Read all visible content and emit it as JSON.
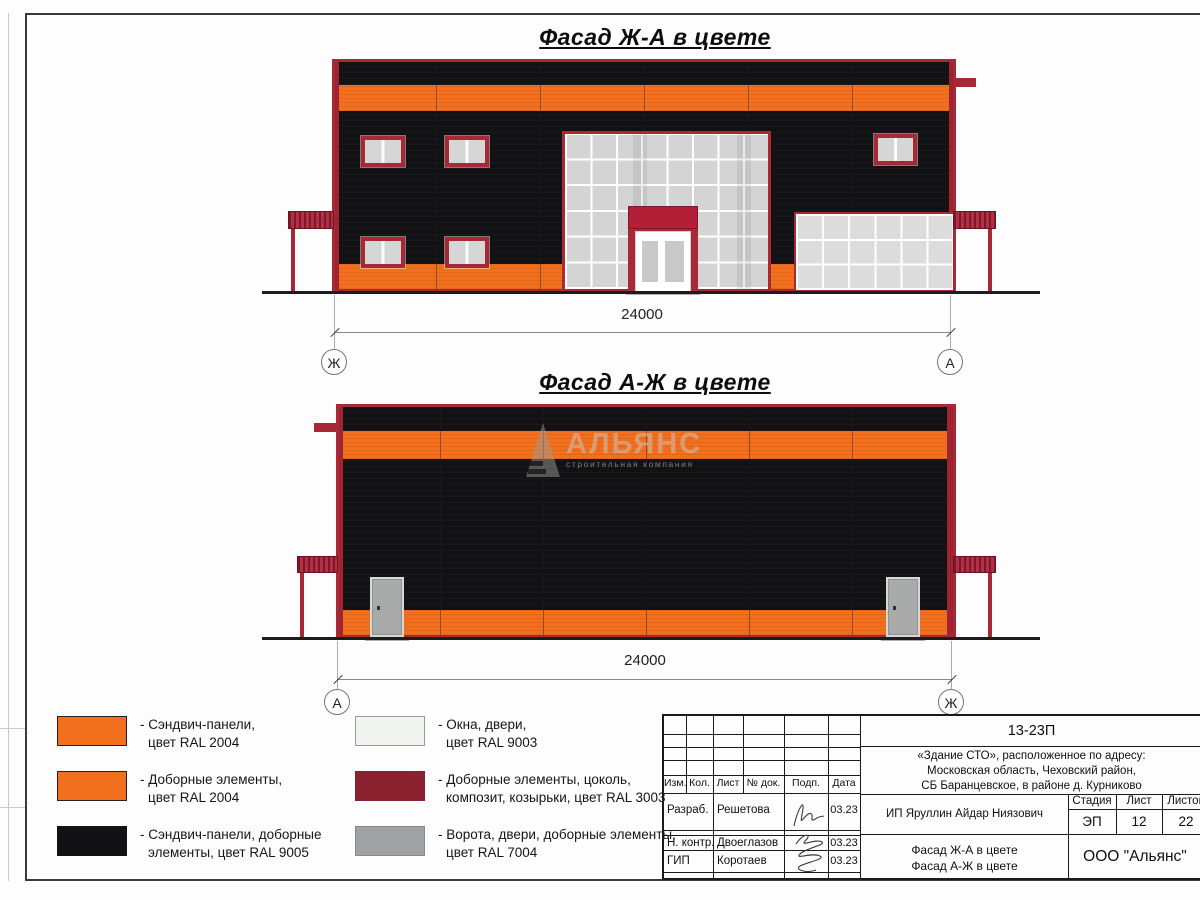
{
  "facade1": {
    "title": "Фасад Ж-А в цвете",
    "dimension": "24000",
    "axis_left": "Ж",
    "axis_right": "А"
  },
  "facade2": {
    "title": "Фасад А-Ж в цвете",
    "dimension": "24000",
    "axis_left": "А",
    "axis_right": "Ж"
  },
  "watermark": {
    "name": "АЛЬЯНС",
    "tagline": "строительная компания"
  },
  "legend": {
    "items": [
      {
        "color": "#F2701D",
        "line1": "- Сэндвич-панели,",
        "line2": "цвет RAL 2004"
      },
      {
        "color": "#F2701D",
        "line1": "- Доборные элементы,",
        "line2": "цвет RAL 2004"
      },
      {
        "color": "#121215",
        "line1": "- Сэндвич-панели, доборные",
        "line2": "элементы, цвет RAL 9005"
      },
      {
        "color": "#F2F4F0",
        "line1": "- Окна, двери,",
        "line2": "цвет RAL 9003"
      },
      {
        "color": "#8C2130",
        "line1": "- Доборные элементы, цоколь,",
        "line2": "композит, козырьки, цвет RAL 3003"
      },
      {
        "color": "#9FA1A2",
        "line1": "- Ворота, двери, доборные элементы,",
        "line2": "цвет RAL 7004"
      }
    ]
  },
  "title_block": {
    "doc_code": "13-23П",
    "address_lines": [
      "«Здание СТО», расположенное по адресу:",
      "Московская область, Чеховский район,",
      "СБ Баранцевское, в районе д. Курниково"
    ],
    "col_headers": [
      "Изм.",
      "Кол.",
      "Лист",
      "№ док.",
      "Подп.",
      "Дата"
    ],
    "stage_cols": [
      "Стадия",
      "Лист",
      "Листов"
    ],
    "stage_vals": [
      "ЭП",
      "12",
      "22"
    ],
    "client": "ИП Яруллин Айдар Ниязович",
    "signers": [
      {
        "role": "Разраб.",
        "name": "Решетова",
        "date": "03.23"
      },
      {
        "role": "Н. контр.",
        "name": "Двоеглазов",
        "date": "03.23"
      },
      {
        "role": "ГИП",
        "name": "Коротаев",
        "date": "03.23"
      }
    ],
    "sheet_name_lines": [
      "Фасад Ж-А в цвете",
      "Фасад А-Ж в цвете"
    ],
    "company": "ООО \"Альянс\""
  },
  "colors": {
    "orange_ral2004": "#F2701D",
    "black_ral9005": "#121215",
    "red_ral3003": "#A82836",
    "white_ral9003": "#F2F4F0",
    "gray_ral7004": "#9FA1A2",
    "glass": "#D6D6D6"
  }
}
